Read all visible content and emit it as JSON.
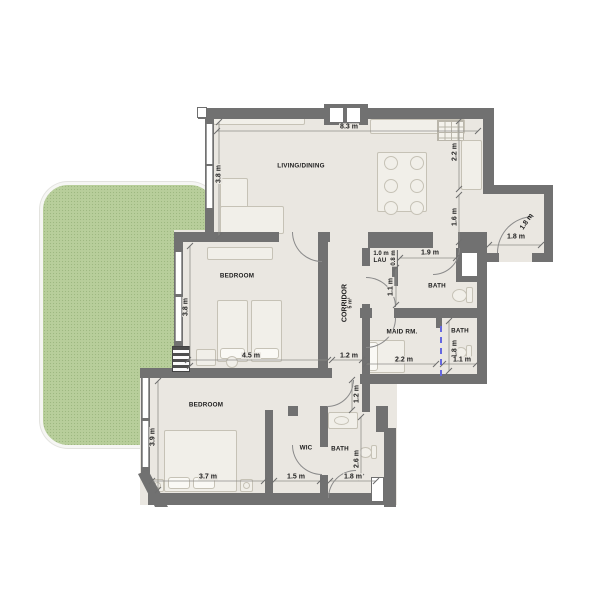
{
  "palette": {
    "wall": "#717171",
    "floor": "#eae7e1",
    "garden": "#b8ce9b",
    "sliding_door": "#6567e0"
  },
  "rooms": {
    "living_dining": {
      "label": "LIVING/DINING"
    },
    "bedroom_1": {
      "label": "BEDROOM"
    },
    "bedroom_2": {
      "label": "BEDROOM"
    },
    "corridor": {
      "label": "CORRIDOR",
      "area": "5 m²"
    },
    "maid_room": {
      "label": "MAID RM."
    },
    "bath_1": {
      "label": "BATH"
    },
    "bath_2": {
      "label": "BATH"
    },
    "bath_3": {
      "label": "BATH"
    },
    "wic": {
      "label": "WIC"
    },
    "laundry": {
      "label": "LAU"
    }
  },
  "dimensions": {
    "living_width": "8.3 m",
    "living_depth": "3.8 m",
    "kitchen_depth": "2.2 m",
    "hall_depth": "1.6 m",
    "entry_width": "1.8 m",
    "entry_door": "1.8 m",
    "laundry_width": "1.0 m",
    "laundry_depth": "0.8 m",
    "bath_1_width": "1.9 m",
    "bath_1_depth": "1.1 m",
    "bedroom_1_depth": "3.8 m",
    "bedroom_1_width": "4.5 m",
    "corridor_width": "1.2 m",
    "corridor_depth": "1.2 m",
    "maid_room_width": "2.2 m",
    "bath_2_depth": "1.8 m",
    "bath_2_width": "1.1 m",
    "bedroom_2_depth": "3.9 m",
    "bedroom_2_width": "3.7 m",
    "wic_width": "1.5 m",
    "bath_3_depth": "2.6 m",
    "bath_3_width": "1.8 m"
  }
}
